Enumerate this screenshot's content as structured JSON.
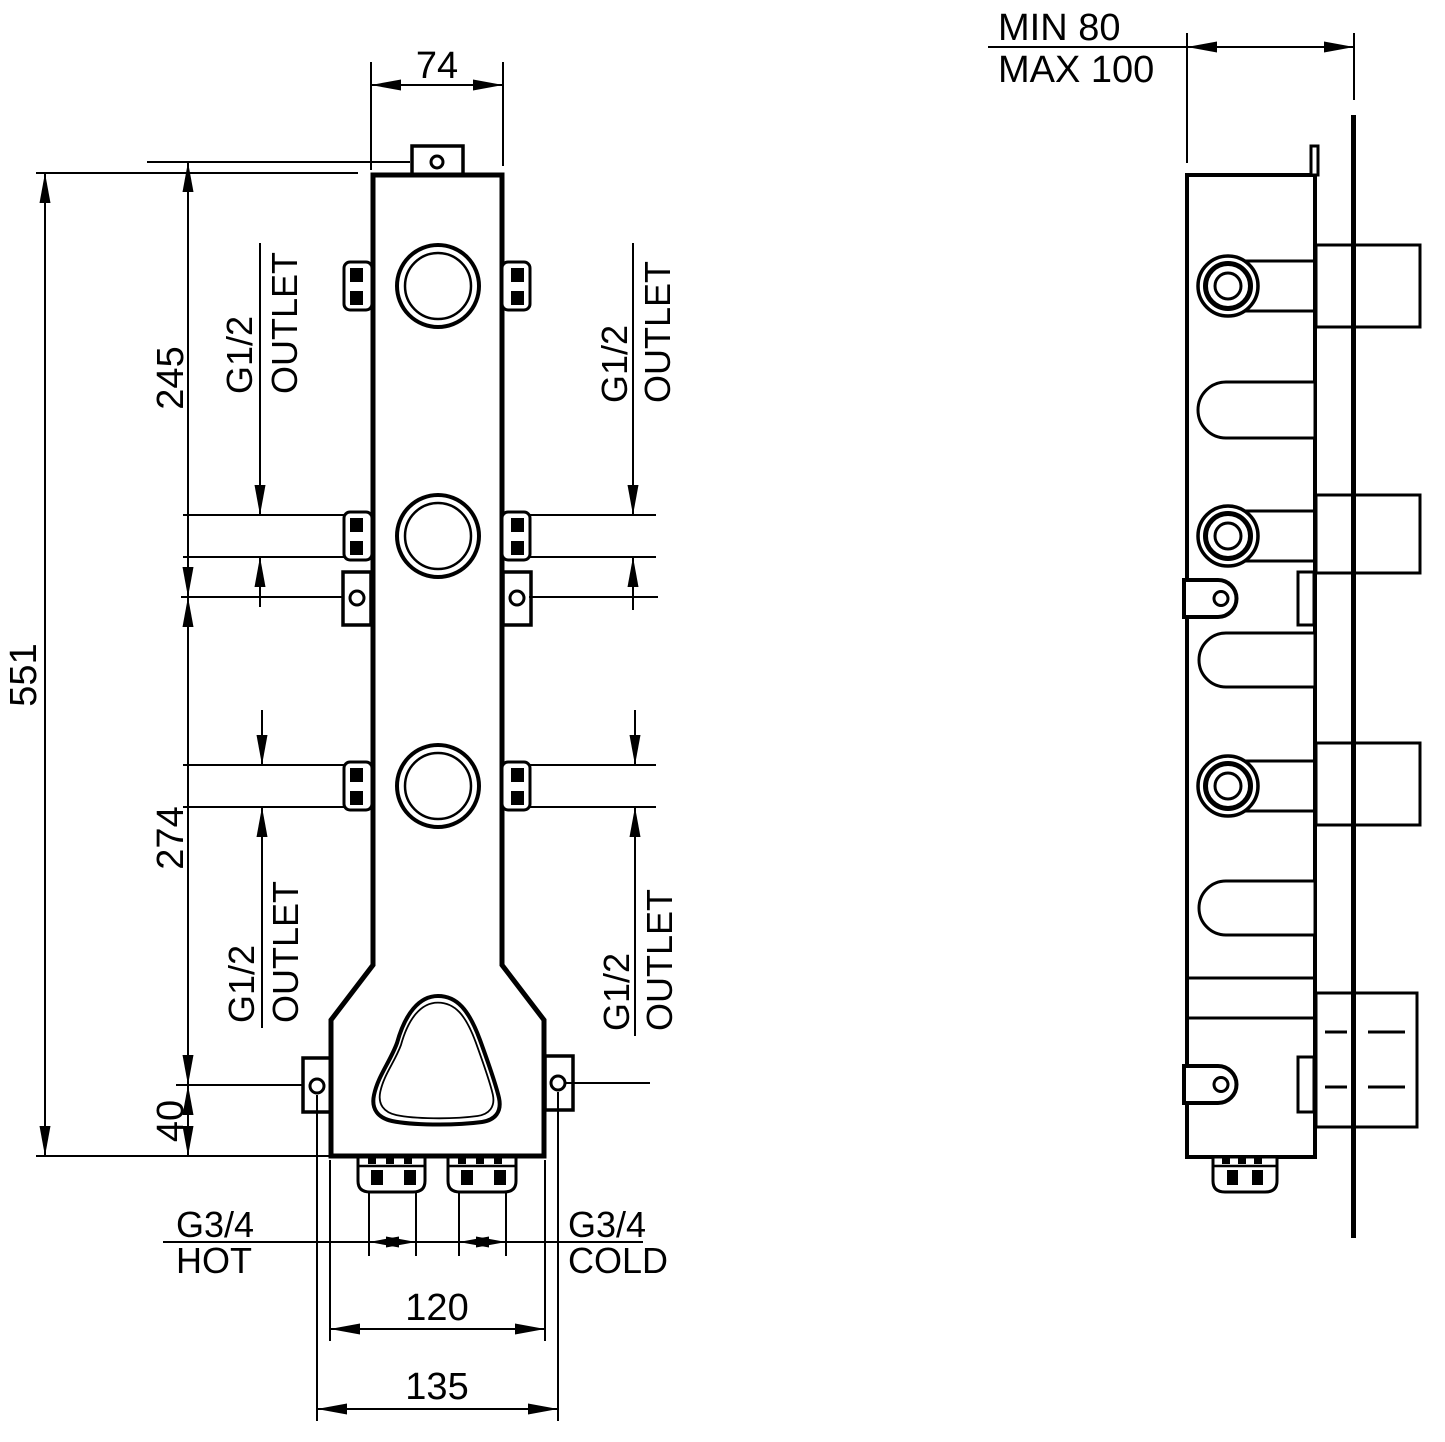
{
  "front_view": {
    "dim_width_top": "74",
    "dim_total_height": "551",
    "dim_top_section": "245",
    "dim_mid_section": "274",
    "dim_bottom_offset": "40",
    "dim_inlet_span": "120",
    "dim_bracket_span": "135",
    "outlet_callouts": [
      {
        "thread": "G1/2",
        "word": "OUTLET"
      },
      {
        "thread": "G1/2",
        "word": "OUTLET"
      },
      {
        "thread": "G1/2",
        "word": "OUTLET"
      },
      {
        "thread": "G1/2",
        "word": "OUTLET"
      }
    ],
    "hot_inlet": {
      "thread": "G3/4",
      "word": "HOT"
    },
    "cold_inlet": {
      "thread": "G3/4",
      "word": "COLD"
    }
  },
  "side_view": {
    "depth_min": "MIN 80",
    "depth_max": "MAX 100"
  },
  "colors": {
    "ink": "#000000",
    "paper": "#ffffff"
  }
}
